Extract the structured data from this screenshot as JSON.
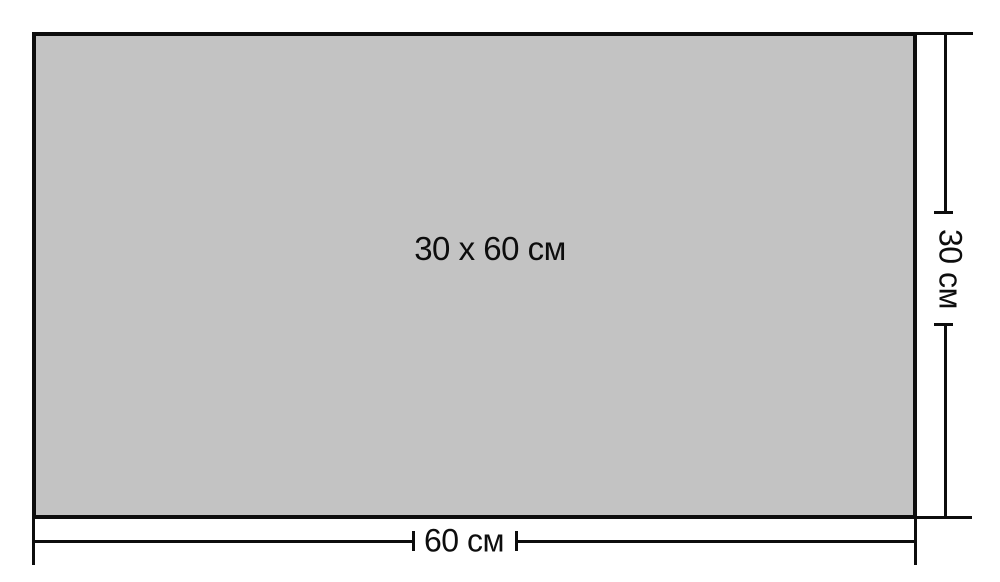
{
  "diagram": {
    "rectangle_label": "30 x 60 см",
    "width_dimension": {
      "label": "60 см"
    },
    "height_dimension": {
      "label": "30 см"
    },
    "colors": {
      "rectangle_fill": "#c3c3c3",
      "line": "#0d0d0d",
      "background": "#ffffff"
    }
  }
}
